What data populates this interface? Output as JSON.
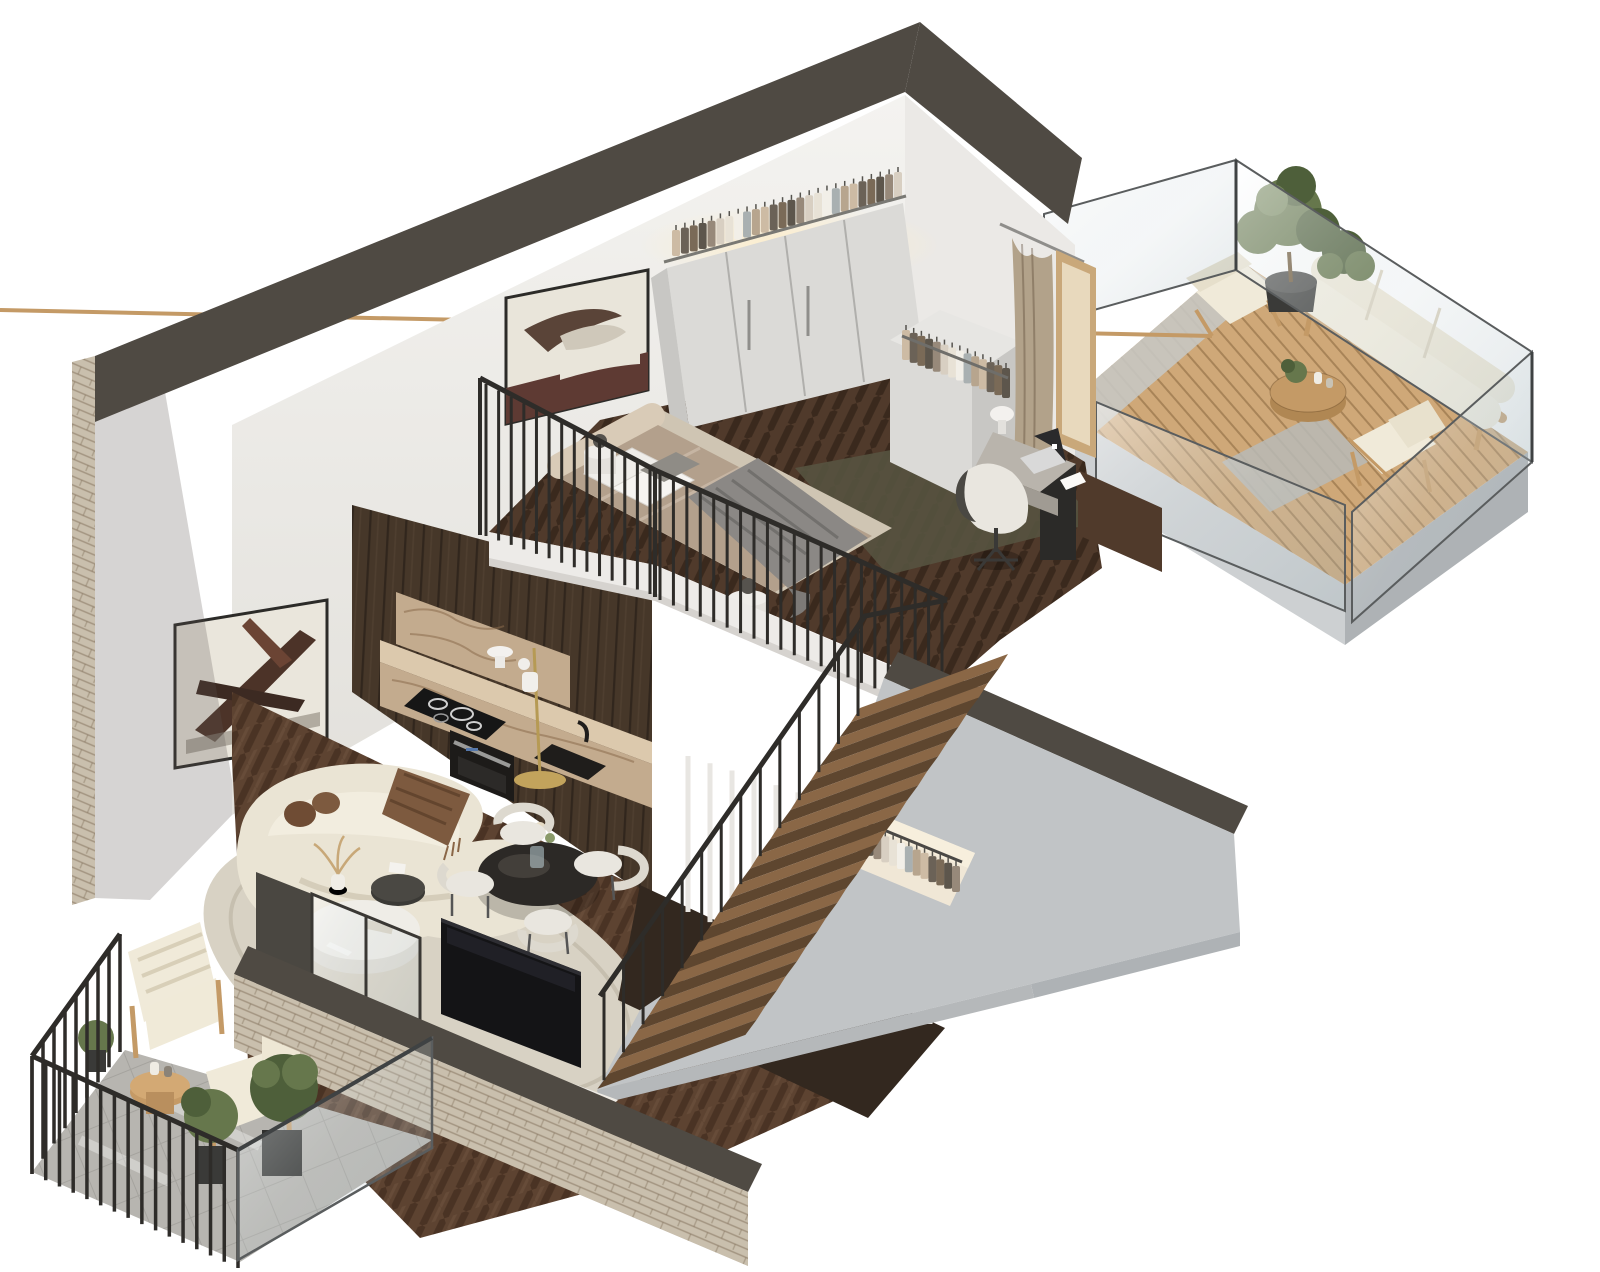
{
  "meta": {
    "type": "3d-isometric-cutaway-floor-plan",
    "subject": "two-level loft apartment with mezzanine bedroom",
    "background": "#ffffff"
  },
  "rooms": [
    {
      "id": "bedroom-mezzanine",
      "level": "upper",
      "furniture": [
        "double-bed",
        "headboard",
        "nightstand-lamps",
        "wardrobe-with-clothes",
        "open-closet-rack",
        "curtain",
        "doorway",
        "work-desk",
        "laptop",
        "desk-lamp",
        "swivel-chair",
        "green-rug",
        "abstract-artwork"
      ]
    },
    {
      "id": "kitchen",
      "level": "lower",
      "furniture": [
        "tall-walnut-cabinets",
        "marble-backsplash",
        "marble-counter",
        "induction-cooktop",
        "built-in-oven",
        "black-sink",
        "counter-lamp",
        "brass-floor-lamp"
      ]
    },
    {
      "id": "living-room",
      "level": "lower",
      "furniture": [
        "curved-boucle-sofa",
        "brown-throw",
        "round-coffee-table",
        "dark-side-table",
        "dried-grass-vase",
        "oval-rug",
        "round-dining-table",
        "dining-chairs",
        "tv",
        "media-console",
        "soundbar",
        "abstract-artwork"
      ]
    },
    {
      "id": "staircase",
      "steps": 13,
      "features": [
        "wood-treads",
        "black-baluster-railing",
        "under-stair-closet-with-clothes",
        "white-slat-screen",
        "gray-stair-wall"
      ]
    },
    {
      "id": "terrace",
      "level": "upper",
      "furniture": [
        "outdoor-sofa",
        "lounge-chair",
        "outdoor-armchair",
        "round-slatted-table",
        "olive-trees-in-pots",
        "glass-balustrade",
        "wood-decking",
        "concrete-path",
        "outdoor-rug"
      ]
    },
    {
      "id": "balcony",
      "level": "lower",
      "furniture": [
        "two-wood-armchairs",
        "striped-cushions",
        "round-side-table",
        "potted-shrubs",
        "black-bar-railing",
        "glass-panel",
        "stone-floor"
      ]
    }
  ],
  "counts": {
    "dining_chairs": 4,
    "left_balusters": 14,
    "front_balusters": 22,
    "stair_balusters": 14,
    "balcony_posts_back": 9,
    "balcony_posts_front": 16,
    "white_slats": 12,
    "wardrobe_hangers": 26,
    "closet_hangers": 14,
    "understair_hangers": 15
  },
  "palette": {
    "bg": "#ffffff",
    "capDark": "#4f4a43",
    "capDark2": "#5a554e",
    "brick": "#c9bfad",
    "brickLine": "#ab9e88",
    "wallWhite": "#f2f1ee",
    "wallShade": "#e4e2de",
    "wallShade2": "#d9d7d2",
    "grayWall": "#c1c4c6",
    "grayWallLo": "#aeb2b5",
    "slab": "#cdd0d2",
    "mezzFloor": "#503a2b",
    "lowerFloor": "#5d4331",
    "woodLine": "#2f2013",
    "kitchenWood": "#463729",
    "kitchenWoodHi": "#5a4834",
    "marble": "#c3ab8e",
    "marbleHi": "#dcc9ad",
    "marbleVein": "#8a6c4d",
    "railBlack": "#2e2c29",
    "fascia": "#edebe8",
    "fasciaShade": "#d6d3cf",
    "stairTread": "#8a6746",
    "stairRiser": "#5e462f",
    "duvet": "#b3a08c",
    "duvetHi": "#c4b29e",
    "throwGray": "#8b8885",
    "pillow": "#efede9",
    "headboard": "#d9cbb7",
    "bedBase": "#cfc5b3",
    "greenRug": "#565340",
    "wardrobe": "#dbdad7",
    "wardrobeSide": "#c8c7c4",
    "curtain": "#b2a28a",
    "doorWood": "#c9a87a",
    "deskTop": "#b9b4ac",
    "deskDark": "#2b2a28",
    "chairCream": "#e9e6df",
    "rugOval": "#d8d2c4",
    "sofaCream": "#eae4d4",
    "sofaShade": "#d5cdba",
    "throwBrown": "#7d5a3f",
    "ballPillow": "#6f4c34",
    "tableWhite": "#efede7",
    "tableDark": "#3b3a36",
    "diningTable": "#2c2926",
    "tvBlack": "#141416",
    "console": "#efece6",
    "consoleShade": "#ddd9d0",
    "soundbar": "#2b2a28",
    "glassEdge": "#5a5d5e",
    "deck": "#cfa878",
    "deckLine": "#a8835a",
    "outdoorWood": "#c49a66",
    "cushionCream": "#f0ead9",
    "plantGreen": "#66774c",
    "plantDark": "#4e5f3a",
    "potDark": "#3a3a38",
    "stone": "#b7b5b0",
    "stoneLine": "#999791",
    "lampGold": "#c2a35c",
    "ledGlow": "#ffeec7",
    "closetWarm": "#f0e7d6"
  }
}
